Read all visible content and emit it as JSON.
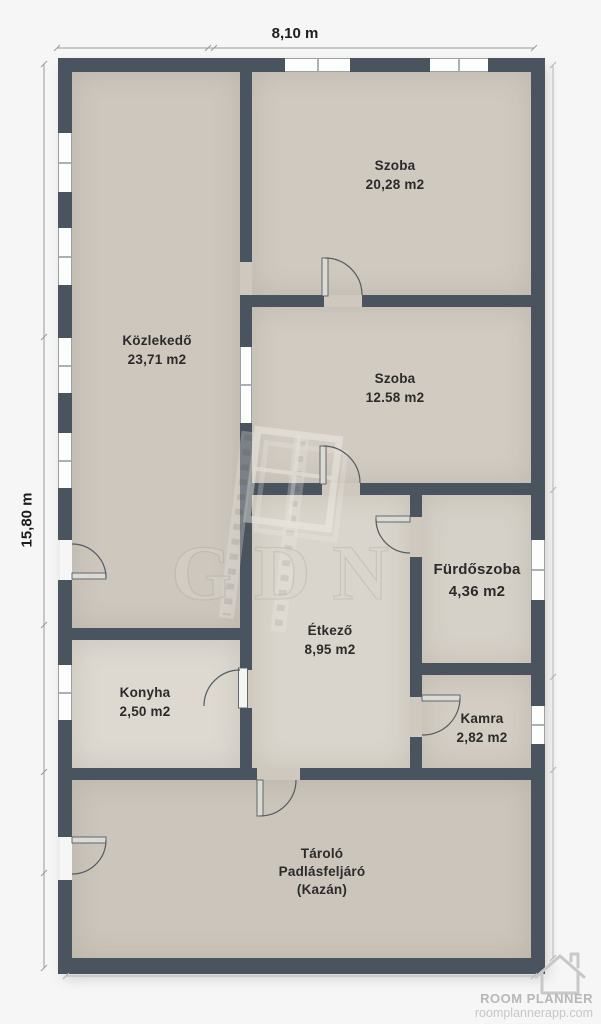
{
  "plan": {
    "dimensions": {
      "width_label": "8,10 m",
      "height_label": "15,80 m"
    },
    "rooms": [
      {
        "id": "szoba-nagy",
        "name": "Szoba",
        "area": "20,28 m2"
      },
      {
        "id": "kozlekedo",
        "name": "Közlekedő",
        "area": "23,71 m2"
      },
      {
        "id": "szoba-kis",
        "name": "Szoba",
        "area": "12.58 m2"
      },
      {
        "id": "furdoszoba",
        "name": "Fürdőszoba",
        "area": "4,36 m2"
      },
      {
        "id": "etkezo",
        "name": "Étkező",
        "area": "8,95 m2"
      },
      {
        "id": "konyha",
        "name": "Konyha",
        "area": "2,50 m2"
      },
      {
        "id": "kamra",
        "name": "Kamra",
        "area": "2,82 m2"
      },
      {
        "id": "tarolo",
        "name": "Tároló",
        "line2": "Padlásfeljáró",
        "line3": "(Kazán)"
      }
    ]
  },
  "watermark": {
    "text": "GDN",
    "icon": "window-frame-icon"
  },
  "branding": {
    "logo_icon": "house-outline-icon",
    "name": "ROOM PLANNER",
    "url": "roomplannerapp.com"
  },
  "palette": {
    "wall": "#4a545f",
    "floor_base": "#cec8bf",
    "floor_light": "#dad5cc",
    "background": "#f6f6f6",
    "label_text": "#2b2b2b",
    "dim_line": "#9a9a9a",
    "logo_text": "#b7b7b7",
    "window_frame": "#99a1a9"
  }
}
